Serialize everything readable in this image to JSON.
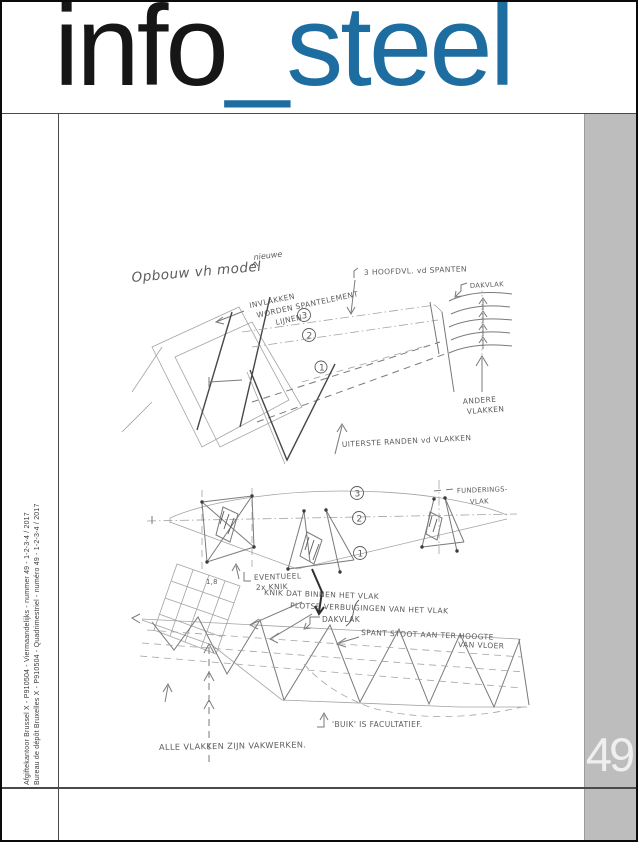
{
  "colors": {
    "accent": "#1e6da0",
    "gray_column": "#bdbdbd",
    "rule": "#4a4a4a",
    "sketch_ink": "#5c5c5c"
  },
  "masthead": {
    "word_black": "info",
    "word_accent": "_steel"
  },
  "spine": {
    "line_left": "Afgiftekantoor Brussel X - P910504 - Viermaandelijks - nummer 49 - 1-2-3-4 / 2017",
    "line_right": "Bureau de dépôt Bruxelles X - P910504 - Quadrimestriel - numéro 49 - 1-2-3-4 / 2017"
  },
  "page_number": "49",
  "sketch": {
    "title": "Opbouw vh model",
    "title_note": "nieuwe",
    "top": {
      "invlakken_l1": "INVLAKKEN",
      "invlakken_l2": "WORDEN SPANTELEMENT",
      "invlakken_l3": "LIJNEN",
      "num3": "3",
      "num2": "2",
      "num1": "1",
      "hoofdvlakken": "3 HOOFDVL. vd SPANTEN",
      "dakvlak": "DAKVLAK",
      "andere_l1": "ANDERE",
      "andere_l2": "VLAKKEN",
      "uiterste": "UITERSTE RANDEN vd VLAKKEN"
    },
    "middle": {
      "num3": "3",
      "num2": "2",
      "num1": "1",
      "funderings_l1": "FUNDERINGS-",
      "funderings_l2": "VLAK",
      "eventueel_l1": "EVENTUEEL",
      "eventueel_l2": "2x KNIK"
    },
    "bottom": {
      "maat": "1,8",
      "knik": "KNIK DAT BINNEN HET VLAK",
      "verbuigingen": "PLOTSE VERBUIGINGEN VAN HET VLAK",
      "dakvlak": "DAKVLAK",
      "spant_l1": "SPANT STOOT AAN TER HOOGTE",
      "spant_l2": "VAN VLOER",
      "buik": "'BUIK' IS FACULTATIEF.",
      "alle": "ALLE VLAKKEN ZIJN VAKWERKEN."
    }
  }
}
